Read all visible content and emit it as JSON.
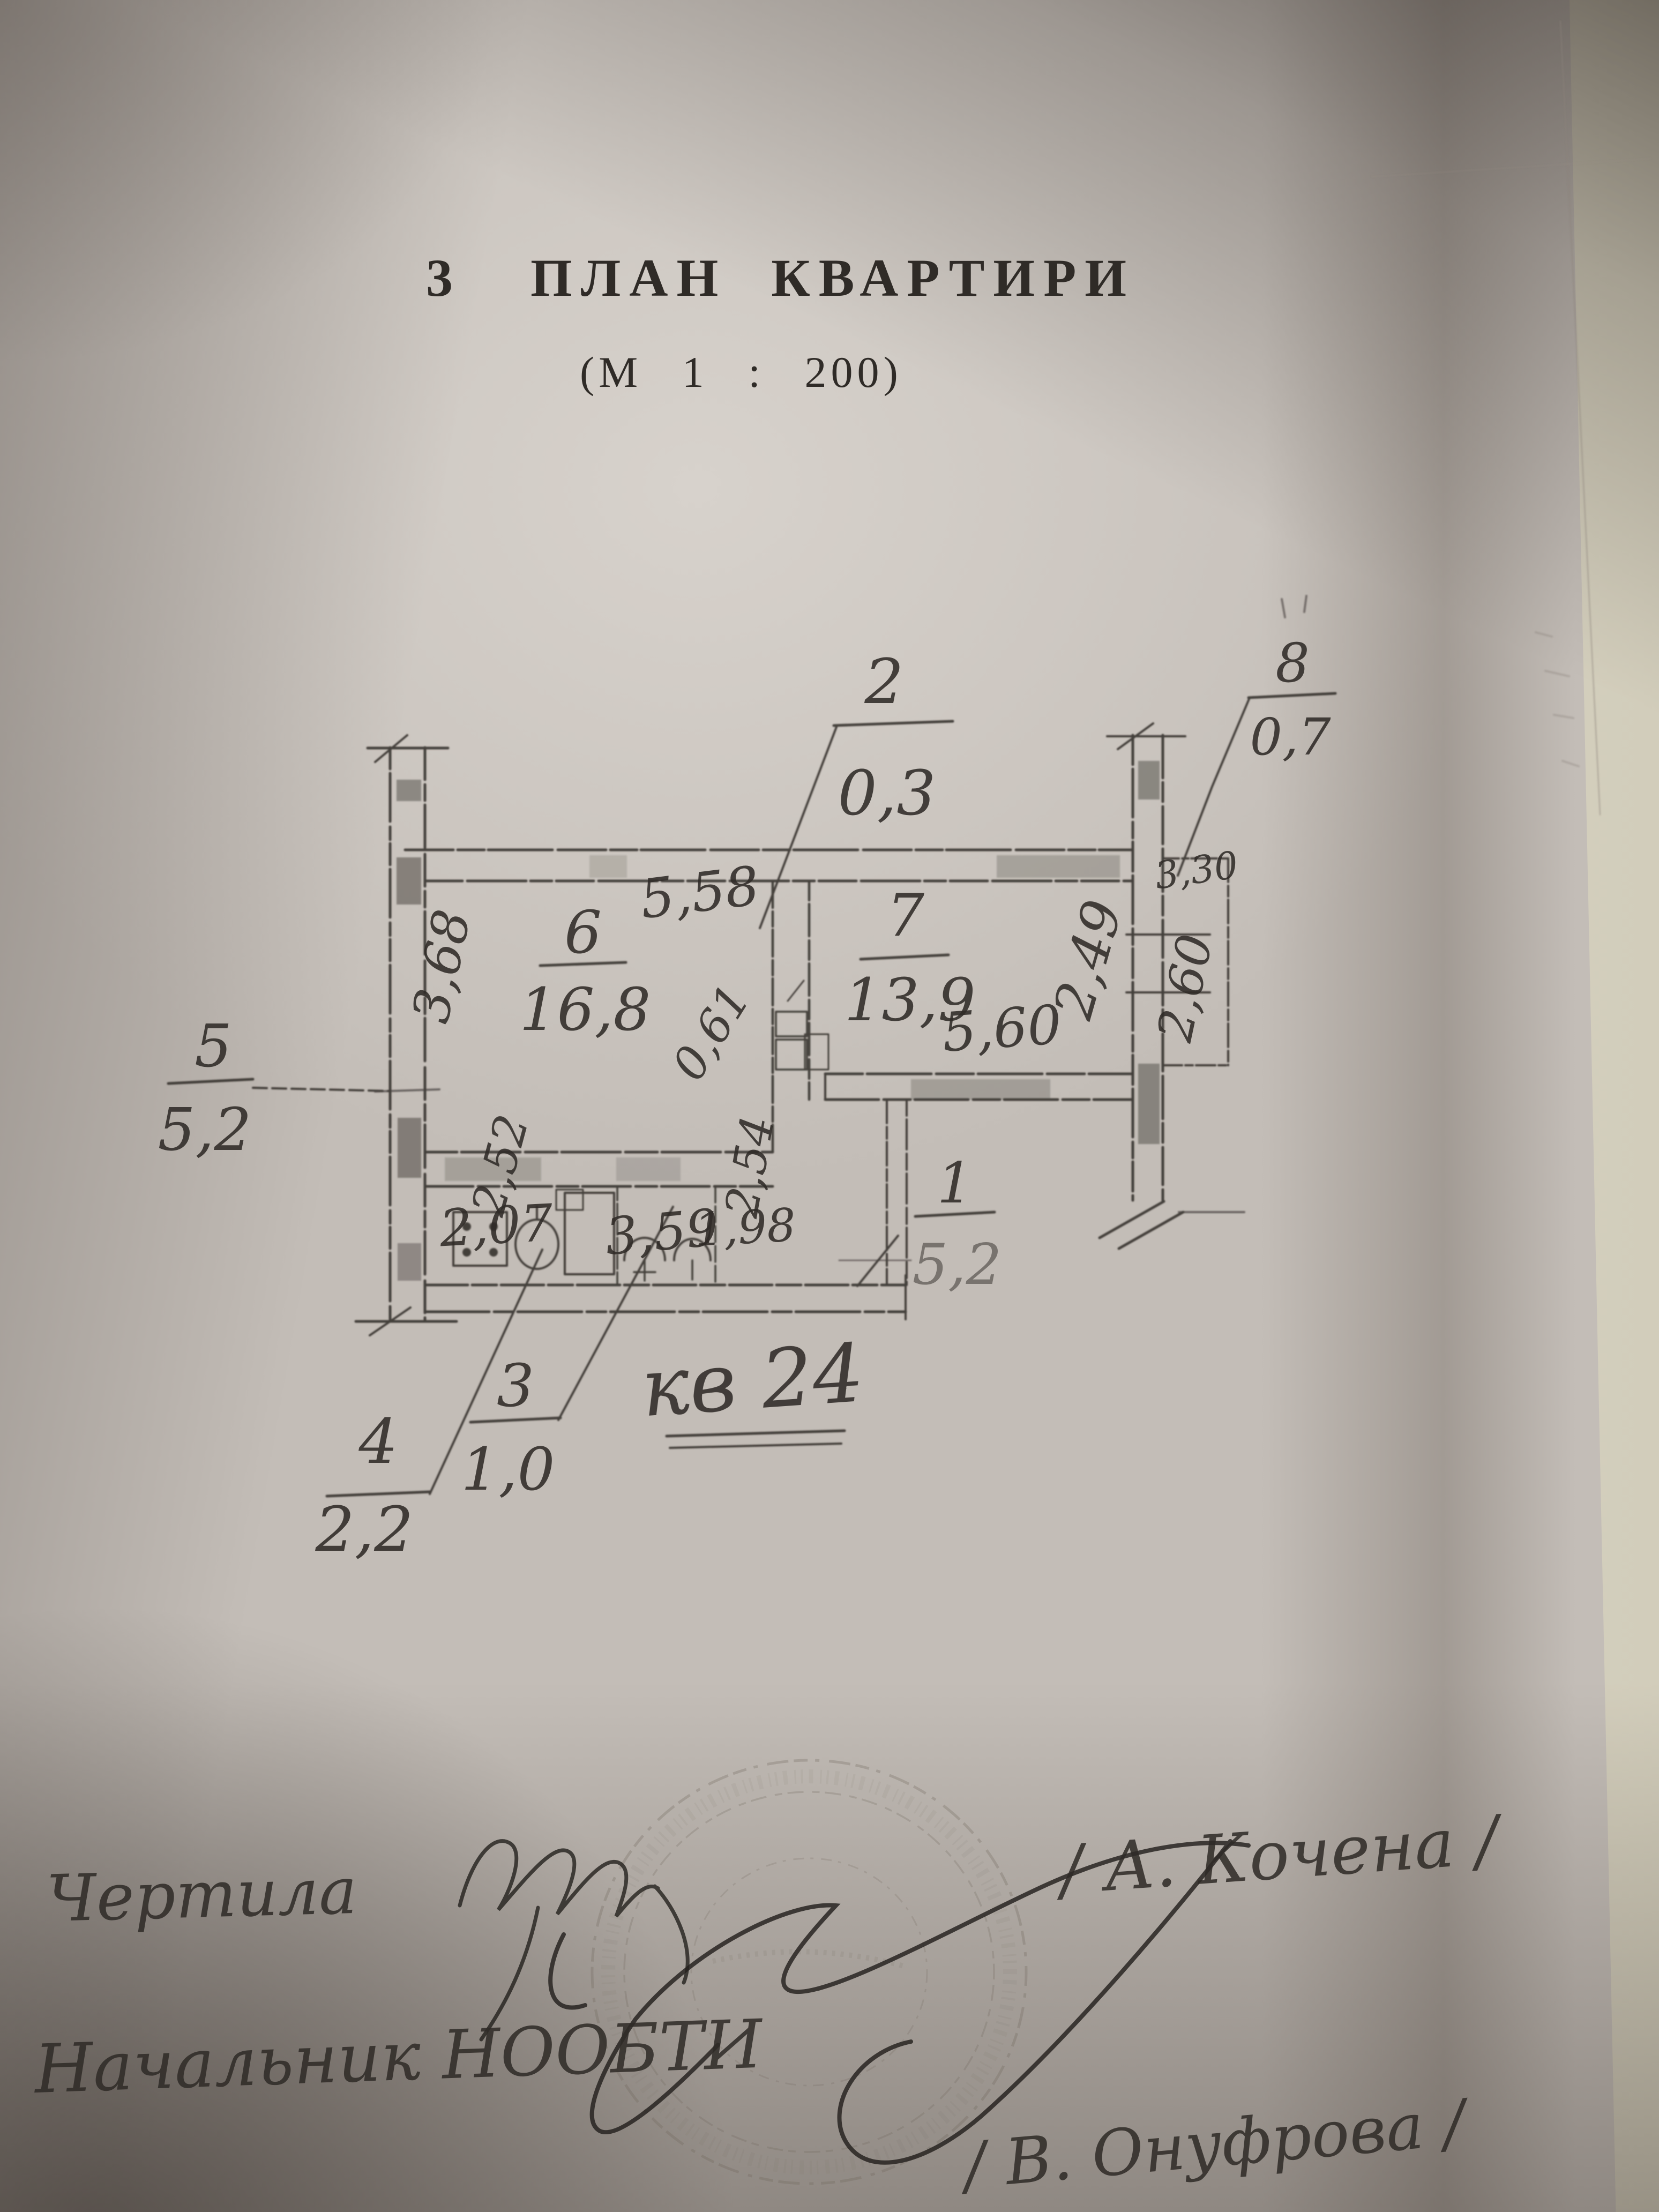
{
  "header": {
    "number": "3",
    "title": "ПЛАН КВАРТИРИ",
    "scale": "(М 1 : 200)"
  },
  "plan": {
    "apartment_label": "кв 24",
    "rooms": {
      "r6": {
        "num": "6",
        "area": "16,8"
      },
      "r7": {
        "num": "7",
        "area": "13,9"
      }
    },
    "callouts": {
      "c1": {
        "num": "1",
        "val": "5,2"
      },
      "c2": {
        "num": "2",
        "val": "0,3"
      },
      "c3": {
        "num": "3",
        "val": "1,0"
      },
      "c4": {
        "num": "4",
        "val": "2,2"
      },
      "c5": {
        "num": "5",
        "val": "5,2"
      },
      "c8": {
        "num": "8",
        "val": "0,7"
      }
    },
    "dims": {
      "room6_top": "5,58",
      "room6_left": "3,68",
      "vent": "0,61",
      "kitchen_a": "2,07",
      "kitchen_b": "3,59",
      "kitchen_h": "2,52",
      "hall": "2,54",
      "bath": "1,98",
      "room7_bottom": "5,60",
      "right_wall": "2,49",
      "balcony_top": "3,30",
      "balcony_right": "2,60"
    }
  },
  "footer": {
    "drafted_label": "Чертила",
    "drafted_name": "/ А. Кочена /",
    "chief_label": "Начальник НООБТИ",
    "chief_name": "/ В. Онуфрова /"
  }
}
